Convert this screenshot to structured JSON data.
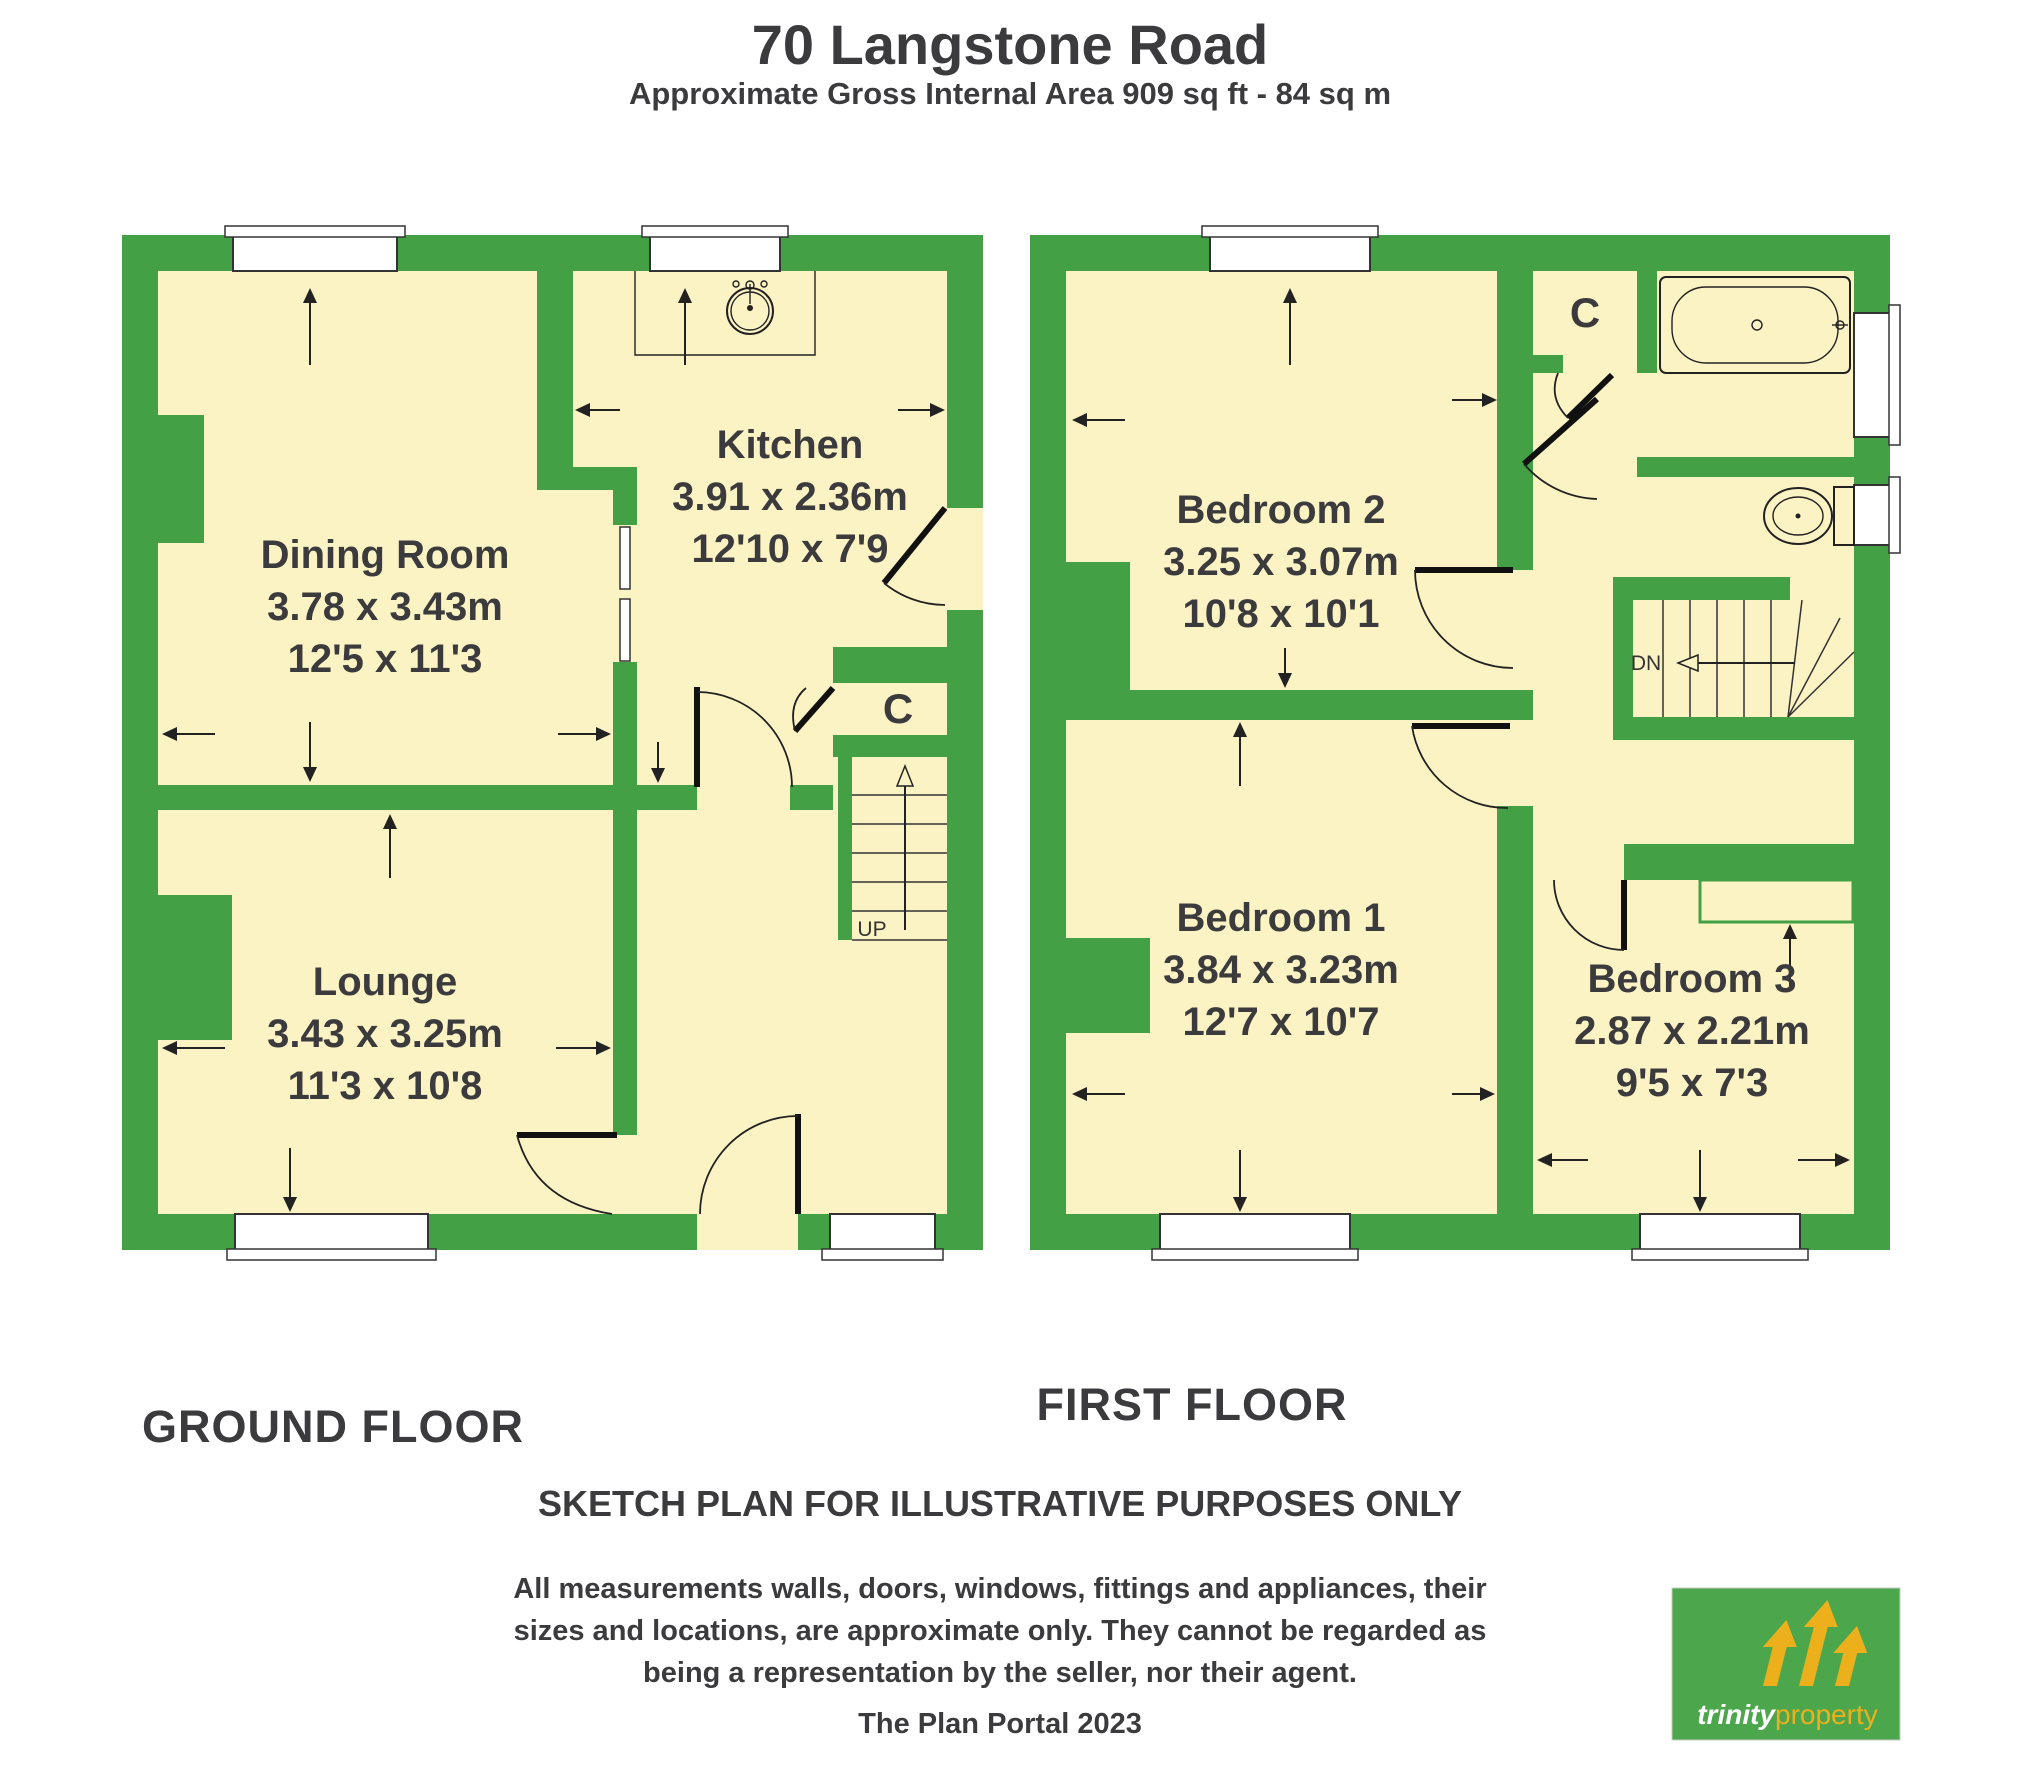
{
  "header": {
    "title": "70 Langstone Road",
    "subtitle": "Approximate Gross Internal Area 909 sq ft - 84 sq m"
  },
  "ground_floor": {
    "label": "GROUND FLOOR",
    "rooms": [
      {
        "name": "Dining Room",
        "size_metric": "3.78 x 3.43m",
        "size_imperial": "12'5 x 11'3"
      },
      {
        "name": "Kitchen",
        "size_metric": "3.91 x 2.36m",
        "size_imperial": "12'10 x 7'9"
      },
      {
        "name": "Lounge",
        "size_metric": "3.43 x 3.25m",
        "size_imperial": "11'3 x 10'8"
      }
    ],
    "cupboard": "C",
    "stairs": "UP"
  },
  "first_floor": {
    "label": "FIRST FLOOR",
    "rooms": [
      {
        "name": "Bedroom 2",
        "size_metric": "3.25 x 3.07m",
        "size_imperial": "10'8 x 10'1"
      },
      {
        "name": "Bedroom 1",
        "size_metric": "3.84 x 3.23m",
        "size_imperial": "12'7 x 10'7"
      },
      {
        "name": "Bedroom 3",
        "size_metric": "2.87 x 2.21m",
        "size_imperial": "9'5 x 7'3"
      }
    ],
    "cupboard": "C",
    "stairs": "DN"
  },
  "footer": {
    "disclaimer_title": "SKETCH PLAN FOR ILLUSTRATIVE PURPOSES ONLY",
    "disclaimer_lines": [
      "All measurements walls, doors, windows, fittings and appliances, their",
      "sizes and locations, are approximate only. They cannot be regarded as",
      "being a representation by the seller, nor their agent."
    ],
    "credit": "The Plan Portal 2023"
  },
  "logo": {
    "brand_bold": "trinity",
    "brand_light": "property"
  },
  "colors": {
    "wall_green": "#44A044",
    "room_cream": "#FCF3C4",
    "logo_green": "#4CA64C",
    "logo_gold": "#EDB01D",
    "text": "#3B3B3D"
  }
}
